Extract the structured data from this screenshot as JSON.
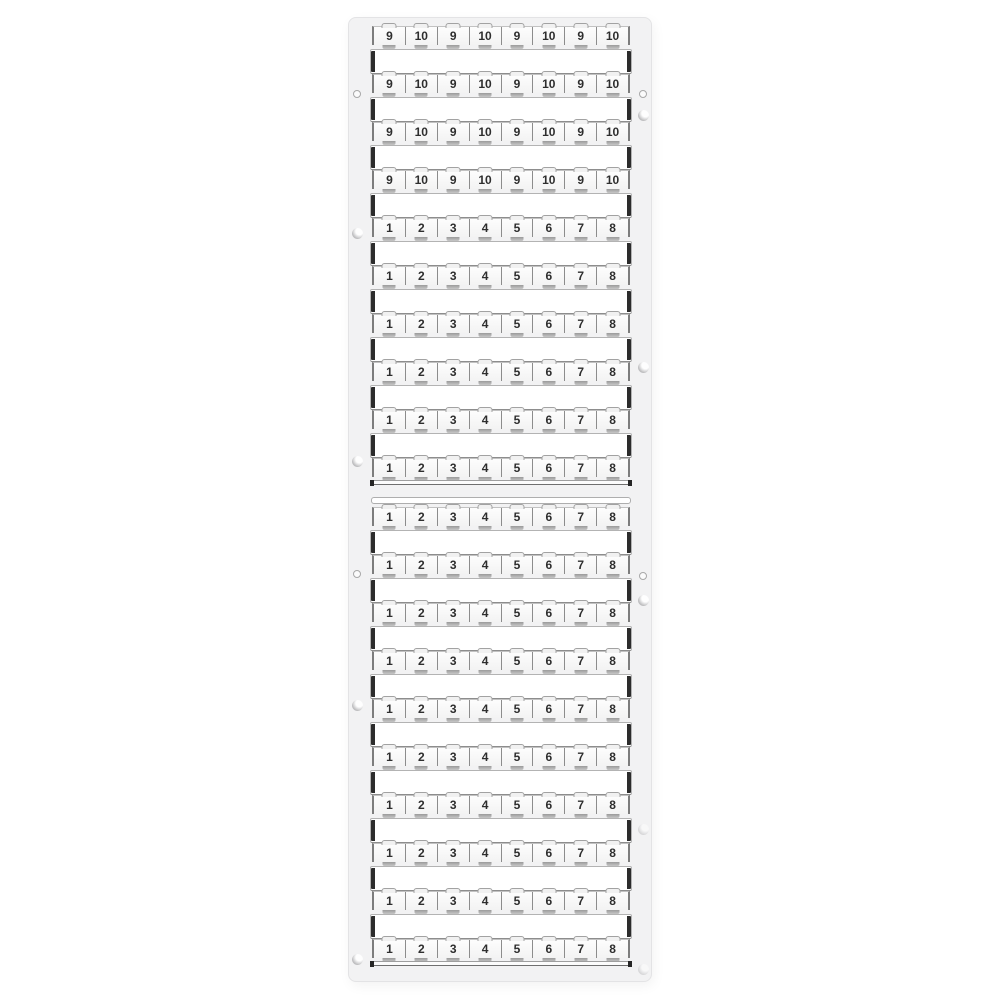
{
  "meta": {
    "type": "product-photo",
    "subject": "Terminal block marker card with pre-printed number strips"
  },
  "colors": {
    "background": "#ffffff",
    "card_frame": "#f2f2f3",
    "blank_strip": "#ffffff",
    "tag_fill": "#fafafa",
    "tag_border": "#8c8c8c",
    "number_text": "#2e2e2e",
    "strip_end_cap": "#2c2c2c"
  },
  "card": {
    "sections": [
      {
        "name": "top",
        "cap_strip": false,
        "rows": [
          {
            "labels": [
              "9",
              "10",
              "9",
              "10",
              "9",
              "10",
              "9",
              "10"
            ]
          },
          {
            "labels": [
              "9",
              "10",
              "9",
              "10",
              "9",
              "10",
              "9",
              "10"
            ]
          },
          {
            "labels": [
              "9",
              "10",
              "9",
              "10",
              "9",
              "10",
              "9",
              "10"
            ]
          },
          {
            "labels": [
              "9",
              "10",
              "9",
              "10",
              "9",
              "10",
              "9",
              "10"
            ]
          },
          {
            "labels": [
              "1",
              "2",
              "3",
              "4",
              "5",
              "6",
              "7",
              "8"
            ]
          },
          {
            "labels": [
              "1",
              "2",
              "3",
              "4",
              "5",
              "6",
              "7",
              "8"
            ]
          },
          {
            "labels": [
              "1",
              "2",
              "3",
              "4",
              "5",
              "6",
              "7",
              "8"
            ]
          },
          {
            "labels": [
              "1",
              "2",
              "3",
              "4",
              "5",
              "6",
              "7",
              "8"
            ]
          },
          {
            "labels": [
              "1",
              "2",
              "3",
              "4",
              "5",
              "6",
              "7",
              "8"
            ]
          },
          {
            "labels": [
              "1",
              "2",
              "3",
              "4",
              "5",
              "6",
              "7",
              "8"
            ]
          }
        ]
      },
      {
        "name": "bottom",
        "cap_strip": true,
        "rows": [
          {
            "labels": [
              "1",
              "2",
              "3",
              "4",
              "5",
              "6",
              "7",
              "8"
            ]
          },
          {
            "labels": [
              "1",
              "2",
              "3",
              "4",
              "5",
              "6",
              "7",
              "8"
            ]
          },
          {
            "labels": [
              "1",
              "2",
              "3",
              "4",
              "5",
              "6",
              "7",
              "8"
            ]
          },
          {
            "labels": [
              "1",
              "2",
              "3",
              "4",
              "5",
              "6",
              "7",
              "8"
            ]
          },
          {
            "labels": [
              "1",
              "2",
              "3",
              "4",
              "5",
              "6",
              "7",
              "8"
            ]
          },
          {
            "labels": [
              "1",
              "2",
              "3",
              "4",
              "5",
              "6",
              "7",
              "8"
            ]
          },
          {
            "labels": [
              "1",
              "2",
              "3",
              "4",
              "5",
              "6",
              "7",
              "8"
            ]
          },
          {
            "labels": [
              "1",
              "2",
              "3",
              "4",
              "5",
              "6",
              "7",
              "8"
            ]
          },
          {
            "labels": [
              "1",
              "2",
              "3",
              "4",
              "5",
              "6",
              "7",
              "8"
            ]
          },
          {
            "labels": [
              "1",
              "2",
              "3",
              "4",
              "5",
              "6",
              "7",
              "8"
            ]
          }
        ]
      }
    ]
  }
}
